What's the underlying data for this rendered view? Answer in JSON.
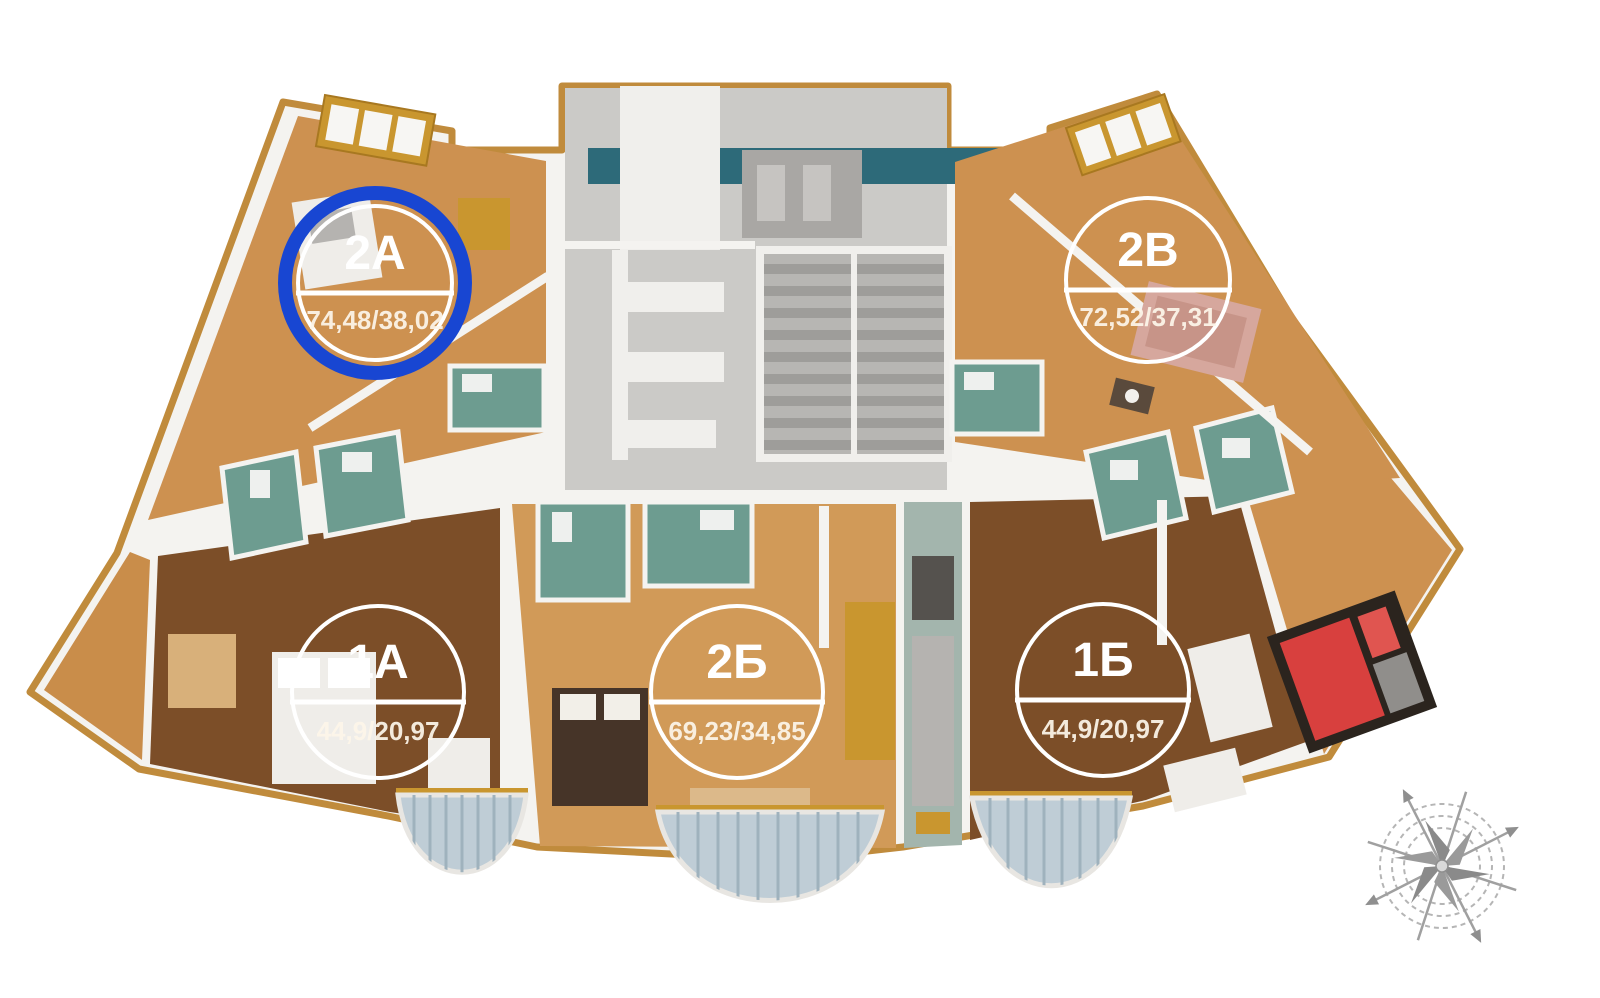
{
  "page": {
    "background": "#ffffff",
    "kind": "3d-apartment-floor-plan-render"
  },
  "apartments": [
    {
      "id": "2А",
      "area": "74,48/38,02",
      "highlighted": true,
      "position": "top-left"
    },
    {
      "id": "2В",
      "area": "72,52/37,31",
      "highlighted": false,
      "position": "top-right"
    },
    {
      "id": "1А",
      "area": "44,9/20,97",
      "highlighted": false,
      "position": "bottom-left"
    },
    {
      "id": "2Б",
      "area": "69,23/34,85",
      "highlighted": false,
      "position": "bottom-center"
    },
    {
      "id": "1Б",
      "area": "44,9/20,97",
      "highlighted": false,
      "position": "bottom-right"
    }
  ],
  "highlight": {
    "shape": "circle",
    "color": "#1846d2",
    "target": "2А"
  },
  "icons": {
    "compass": "compass-rose-icon"
  },
  "colors": {
    "wall_white": "#f4f3f0",
    "wall_gold": "#c08b3c",
    "floor_orange": "#cd9150",
    "floor_orange_light": "#d19a58",
    "floor_brown": "#7c4e28",
    "bathroom_teal": "#6d9c90",
    "glazing_teal": "#2d6a79",
    "core_gray": "#cbcac7",
    "stair_gray": "#9e9d9a",
    "balcony_glass": "#bfcdd6",
    "bed_red": "#d8403e",
    "marker_white": "#ffffff",
    "compass_gray": "#a8a8a8"
  }
}
